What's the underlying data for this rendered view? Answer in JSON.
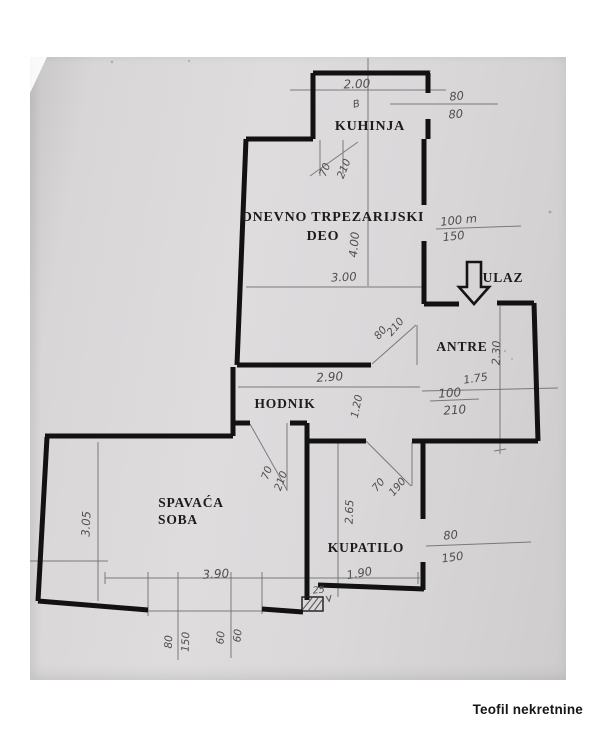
{
  "watermark": "Teofil nekretnine",
  "colors": {
    "paper": "#d8d6d7",
    "wall": "#121212",
    "pencil": "#6a6a6a",
    "handwriting": "#4f4f4f",
    "label": "#1c1c1c"
  },
  "plan": {
    "room_labels": {
      "kuhinja": "KUHINJA",
      "dnevno_line1": "DNEVNO TRPEZARIJSKI",
      "dnevno_line2": "DEO",
      "ulaz": "ULAZ",
      "antre": "ANTRE",
      "hodnik": "HODNIK",
      "spavaca_line1": "SPAVAĆA",
      "spavaca_line2": "SOBA",
      "kupatilo": "KUPATILO"
    },
    "dim_labels": [
      {
        "t": "2.00",
        "x": 357,
        "y": 88,
        "r": -2,
        "fs": 12
      },
      {
        "t": "80",
        "x": 457,
        "y": 100,
        "r": -6,
        "fs": 11.5
      },
      {
        "t": "80",
        "x": 456,
        "y": 118,
        "r": -4,
        "fs": 11.5
      },
      {
        "t": "70",
        "x": 328,
        "y": 171,
        "r": -68,
        "fs": 10.5
      },
      {
        "t": "210",
        "x": 347,
        "y": 170,
        "r": -68,
        "fs": 10.5
      },
      {
        "t": "4.00",
        "x": 358,
        "y": 245,
        "r": -85,
        "fs": 11.5
      },
      {
        "t": "100 m",
        "x": 459,
        "y": 224,
        "r": -6,
        "fs": 11.5
      },
      {
        "t": "150",
        "x": 454,
        "y": 240,
        "r": -6,
        "fs": 11.5
      },
      {
        "t": "3.00",
        "x": 344,
        "y": 281,
        "r": -3,
        "fs": 11.5
      },
      {
        "t": "80",
        "x": 383,
        "y": 335,
        "r": -50,
        "fs": 10.5
      },
      {
        "t": "210",
        "x": 398,
        "y": 329,
        "r": -50,
        "fs": 10.5
      },
      {
        "t": "2.30",
        "x": 500,
        "y": 353,
        "r": -88,
        "fs": 11
      },
      {
        "t": "1.75",
        "x": 476,
        "y": 382,
        "r": -8,
        "fs": 11
      },
      {
        "t": "100",
        "x": 450,
        "y": 397,
        "r": -4,
        "fs": 12
      },
      {
        "t": "210",
        "x": 455,
        "y": 414,
        "r": -4,
        "fs": 12
      },
      {
        "t": "2.90",
        "x": 330,
        "y": 381,
        "r": -4,
        "fs": 12
      },
      {
        "t": "1.20",
        "x": 360,
        "y": 407,
        "r": -78,
        "fs": 10.5
      },
      {
        "t": "70",
        "x": 270,
        "y": 474,
        "r": -70,
        "fs": 10.5
      },
      {
        "t": "210",
        "x": 284,
        "y": 482,
        "r": -70,
        "fs": 10.5
      },
      {
        "t": "3.05",
        "x": 90,
        "y": 524,
        "r": -88,
        "fs": 11.5
      },
      {
        "t": "2.65",
        "x": 353,
        "y": 512,
        "r": -88,
        "fs": 11
      },
      {
        "t": "70",
        "x": 381,
        "y": 487,
        "r": -50,
        "fs": 10.5
      },
      {
        "t": "190",
        "x": 400,
        "y": 489,
        "r": -50,
        "fs": 10.5
      },
      {
        "t": "80",
        "x": 451,
        "y": 539,
        "r": -6,
        "fs": 11.5
      },
      {
        "t": "150",
        "x": 453,
        "y": 561,
        "r": -8,
        "fs": 11.5
      },
      {
        "t": "1.90",
        "x": 360,
        "y": 577,
        "r": -10,
        "fs": 11.5
      },
      {
        "t": "3.90",
        "x": 216,
        "y": 578,
        "r": -3,
        "fs": 12
      },
      {
        "t": "25",
        "x": 319,
        "y": 593,
        "r": -6,
        "fs": 9.5
      },
      {
        "t": "80",
        "x": 172,
        "y": 642,
        "r": -88,
        "fs": 10.5
      },
      {
        "t": "150",
        "x": 189,
        "y": 642,
        "r": -88,
        "fs": 10.5
      },
      {
        "t": "60",
        "x": 224,
        "y": 638,
        "r": -85,
        "fs": 10.5
      },
      {
        "t": "60",
        "x": 241,
        "y": 636,
        "r": -85,
        "fs": 10.5
      },
      {
        "t": "B",
        "x": 357,
        "y": 107,
        "r": -12,
        "fs": 10
      }
    ]
  }
}
